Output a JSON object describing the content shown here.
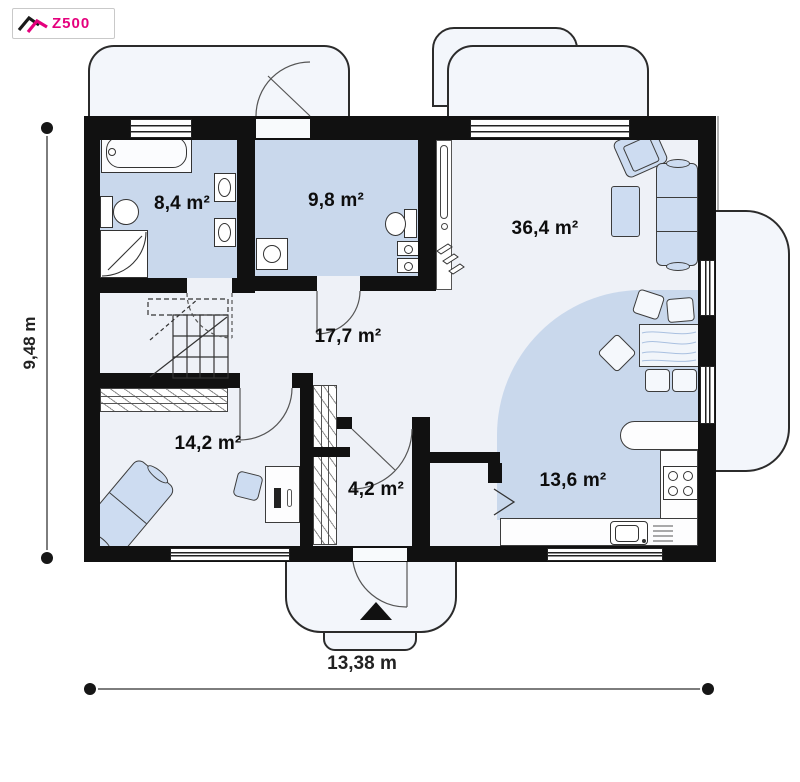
{
  "logo": {
    "text": "Z500"
  },
  "rooms": [
    {
      "name": "bathroom",
      "area": "8,4 m²"
    },
    {
      "name": "utility-room",
      "area": "9,8 m²"
    },
    {
      "name": "living-room",
      "area": "36,4 m²"
    },
    {
      "name": "hallway",
      "area": "17,7 m²"
    },
    {
      "name": "bedroom",
      "area": "14,2 m²"
    },
    {
      "name": "entry",
      "area": "4,2 m²"
    },
    {
      "name": "kitchen",
      "area": "13,6 m²"
    }
  ],
  "dimensions": {
    "vertical": "9,48 m",
    "horizontal": "13,38 m"
  },
  "colors": {
    "brand": "#e5007d",
    "wall": "#111111",
    "room_fill": "#c9d8ec",
    "floor_fill": "#eef1f7",
    "furniture_fill": "#cddcf1"
  }
}
